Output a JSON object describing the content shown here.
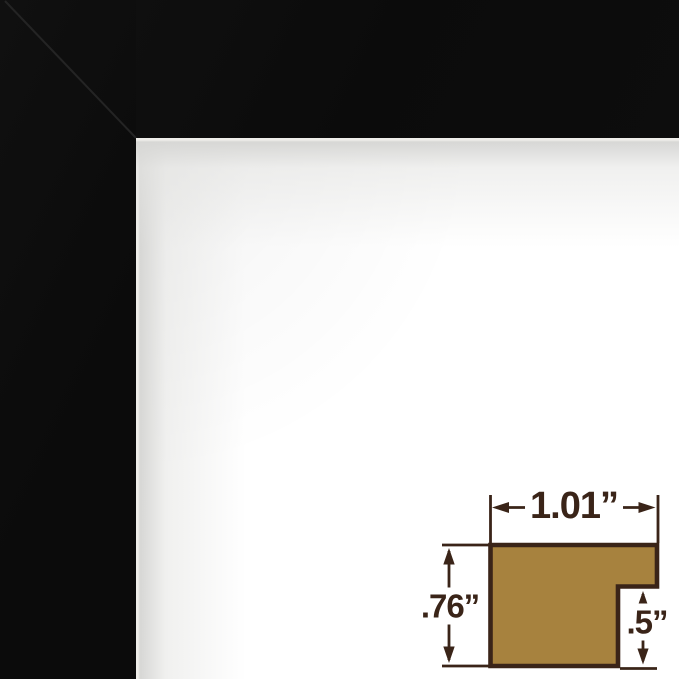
{
  "frame": {
    "color": "#0c0c0c",
    "opening_highlight": "#efeeea"
  },
  "diagram": {
    "width_label": "1.01”",
    "height_label": ".76”",
    "rabbet_label": ".5”",
    "profile_fill": "#a7823e",
    "outline_color": "#3a2418",
    "label_color": "#3a2418"
  }
}
